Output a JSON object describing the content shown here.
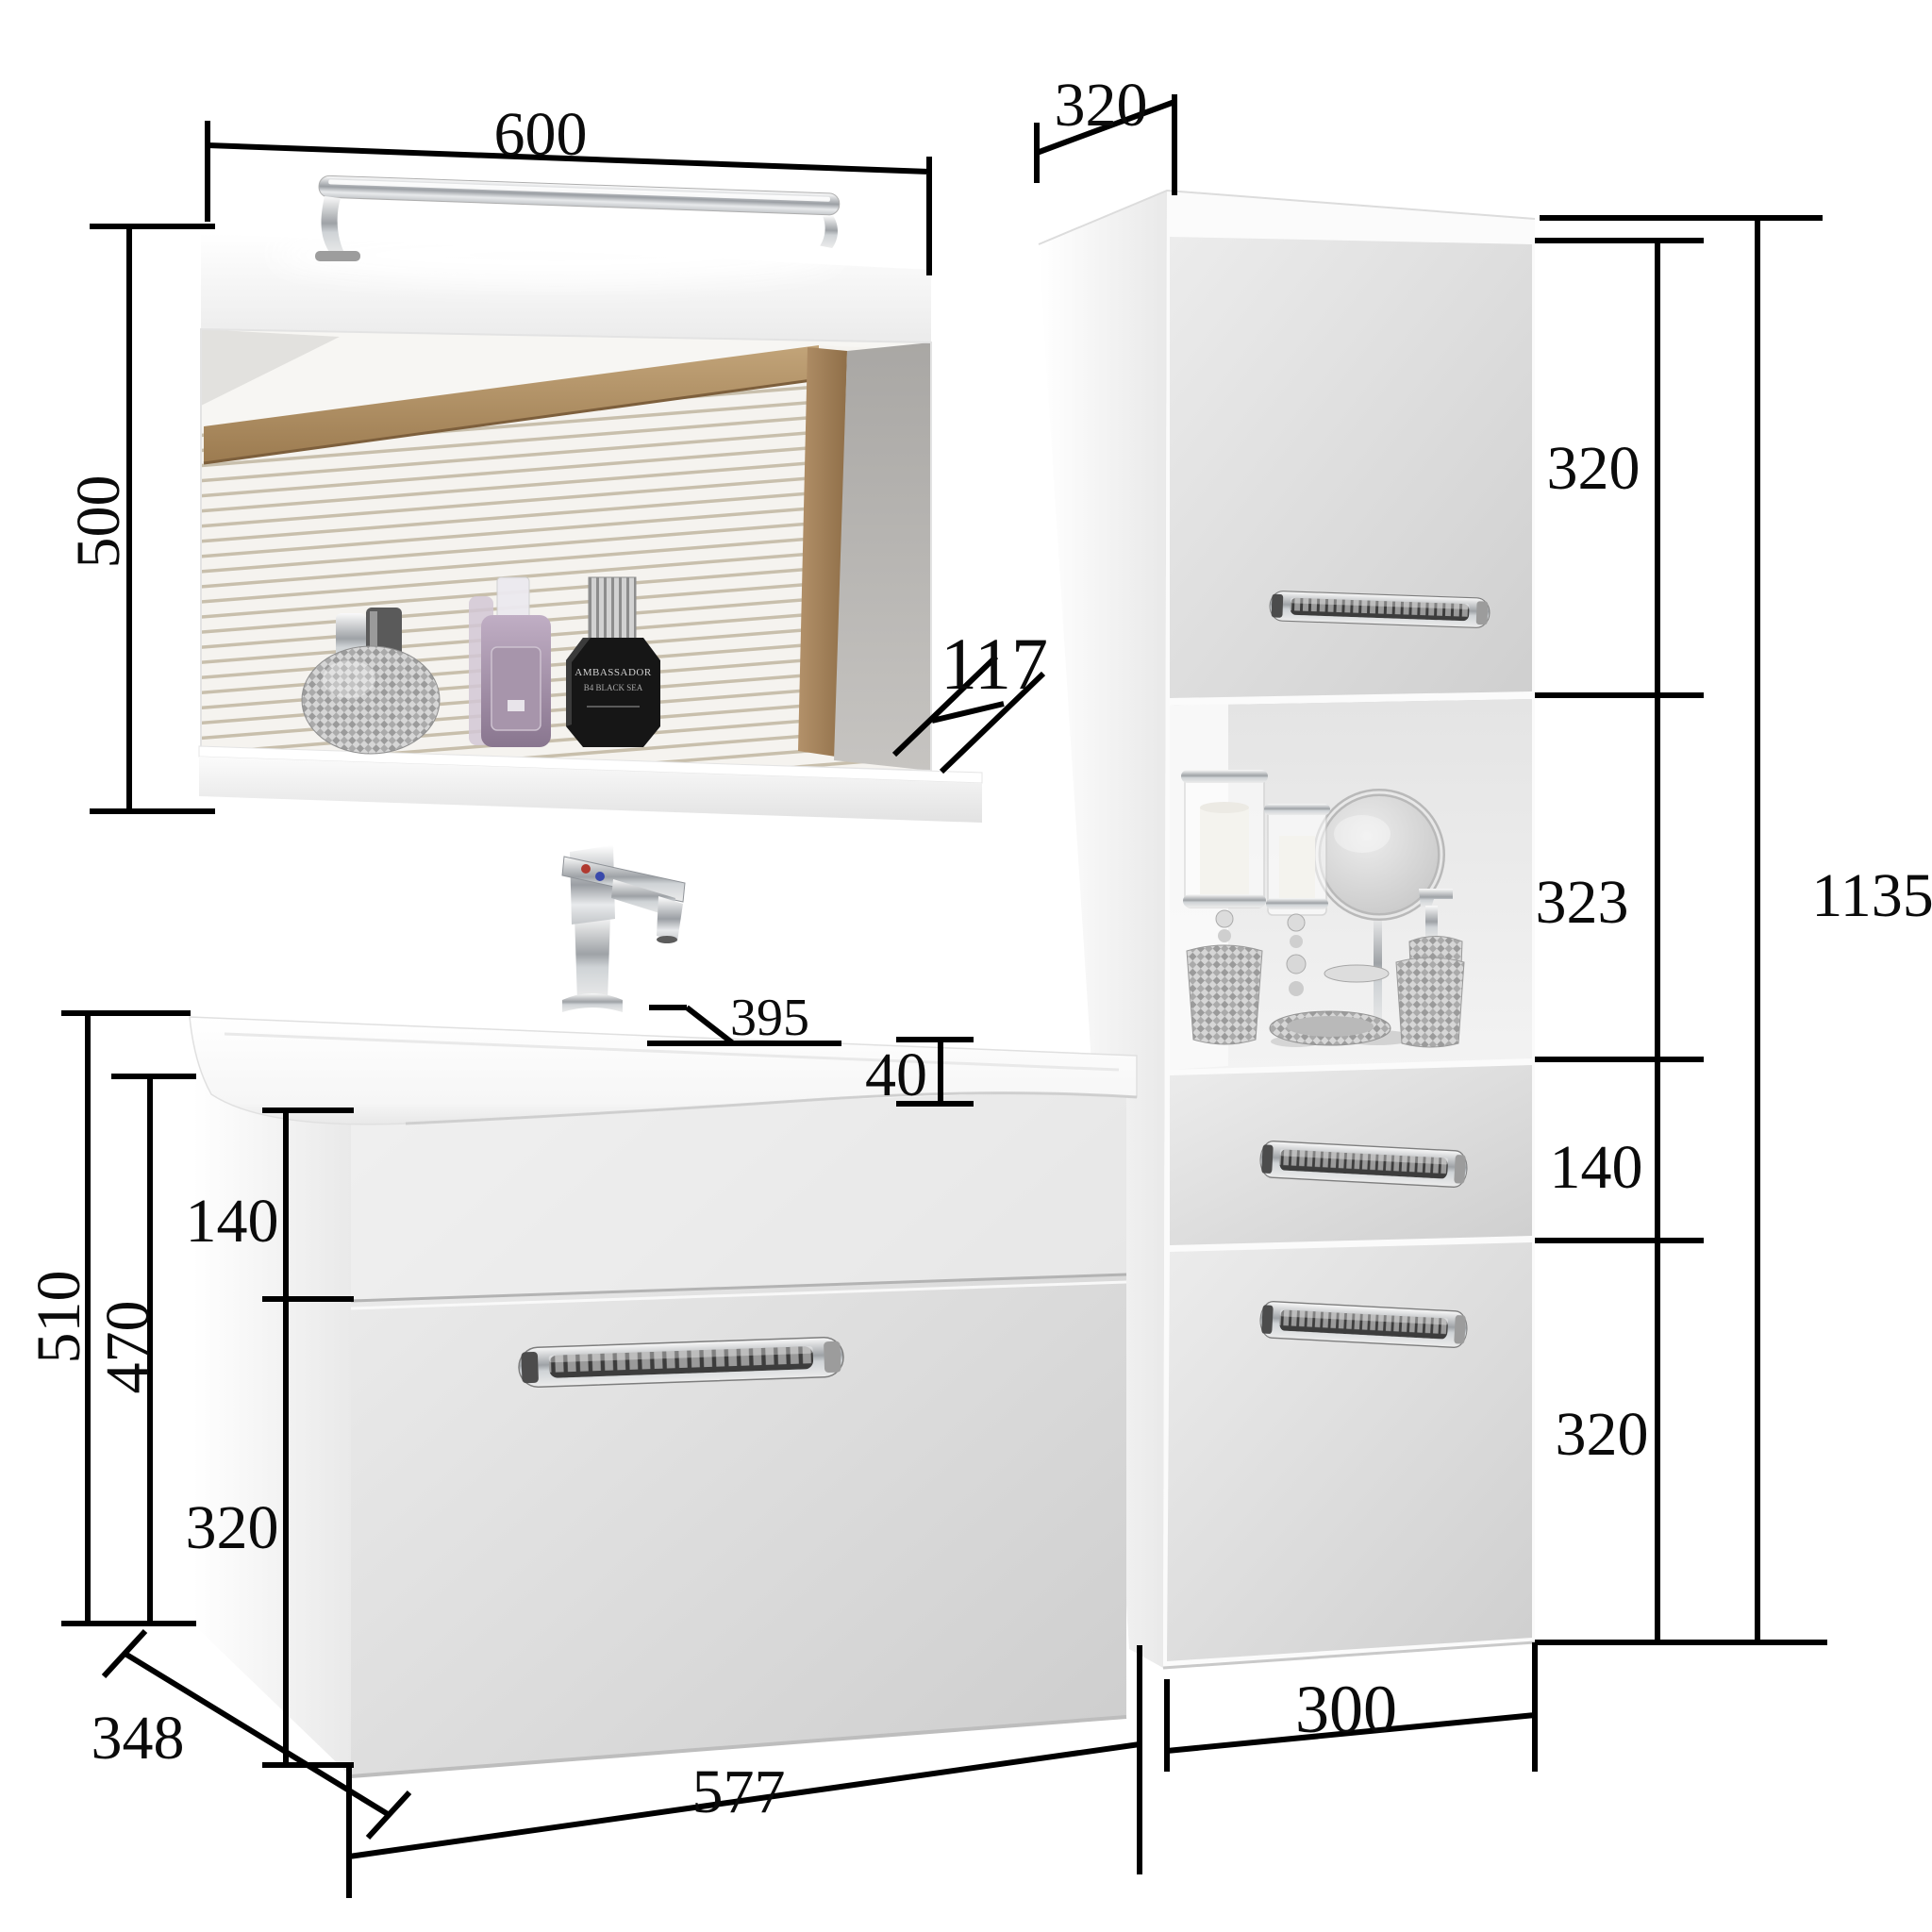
{
  "dimensions": {
    "mirror_width": "600",
    "mirror_height": "500",
    "shelf_depth": "117",
    "tall_cabinet_depth": "320",
    "tall_cabinet_upper_door_height": "320",
    "tall_cabinet_niche_height": "323",
    "tall_cabinet_total_height": "1135",
    "tall_cabinet_drawer_height": "140",
    "tall_cabinet_lower_door_height": "320",
    "tall_cabinet_width": "300",
    "basin_depth": "395",
    "basin_edge_thickness": "40",
    "vanity_total_height": "510",
    "vanity_body_height": "470",
    "vanity_top_drawer_height": "140",
    "vanity_bottom_drawer_height": "320",
    "vanity_depth": "348",
    "vanity_width": "577"
  },
  "perfume_bottle": {
    "brand": "AMBASSADOR",
    "variant": "B4 BLACK SEA"
  },
  "colors": {
    "dimension_line": "#000000",
    "wood_frame": "#ad8a5d",
    "cabinet_front": "#d9d9d9",
    "background": "#ffffff"
  }
}
